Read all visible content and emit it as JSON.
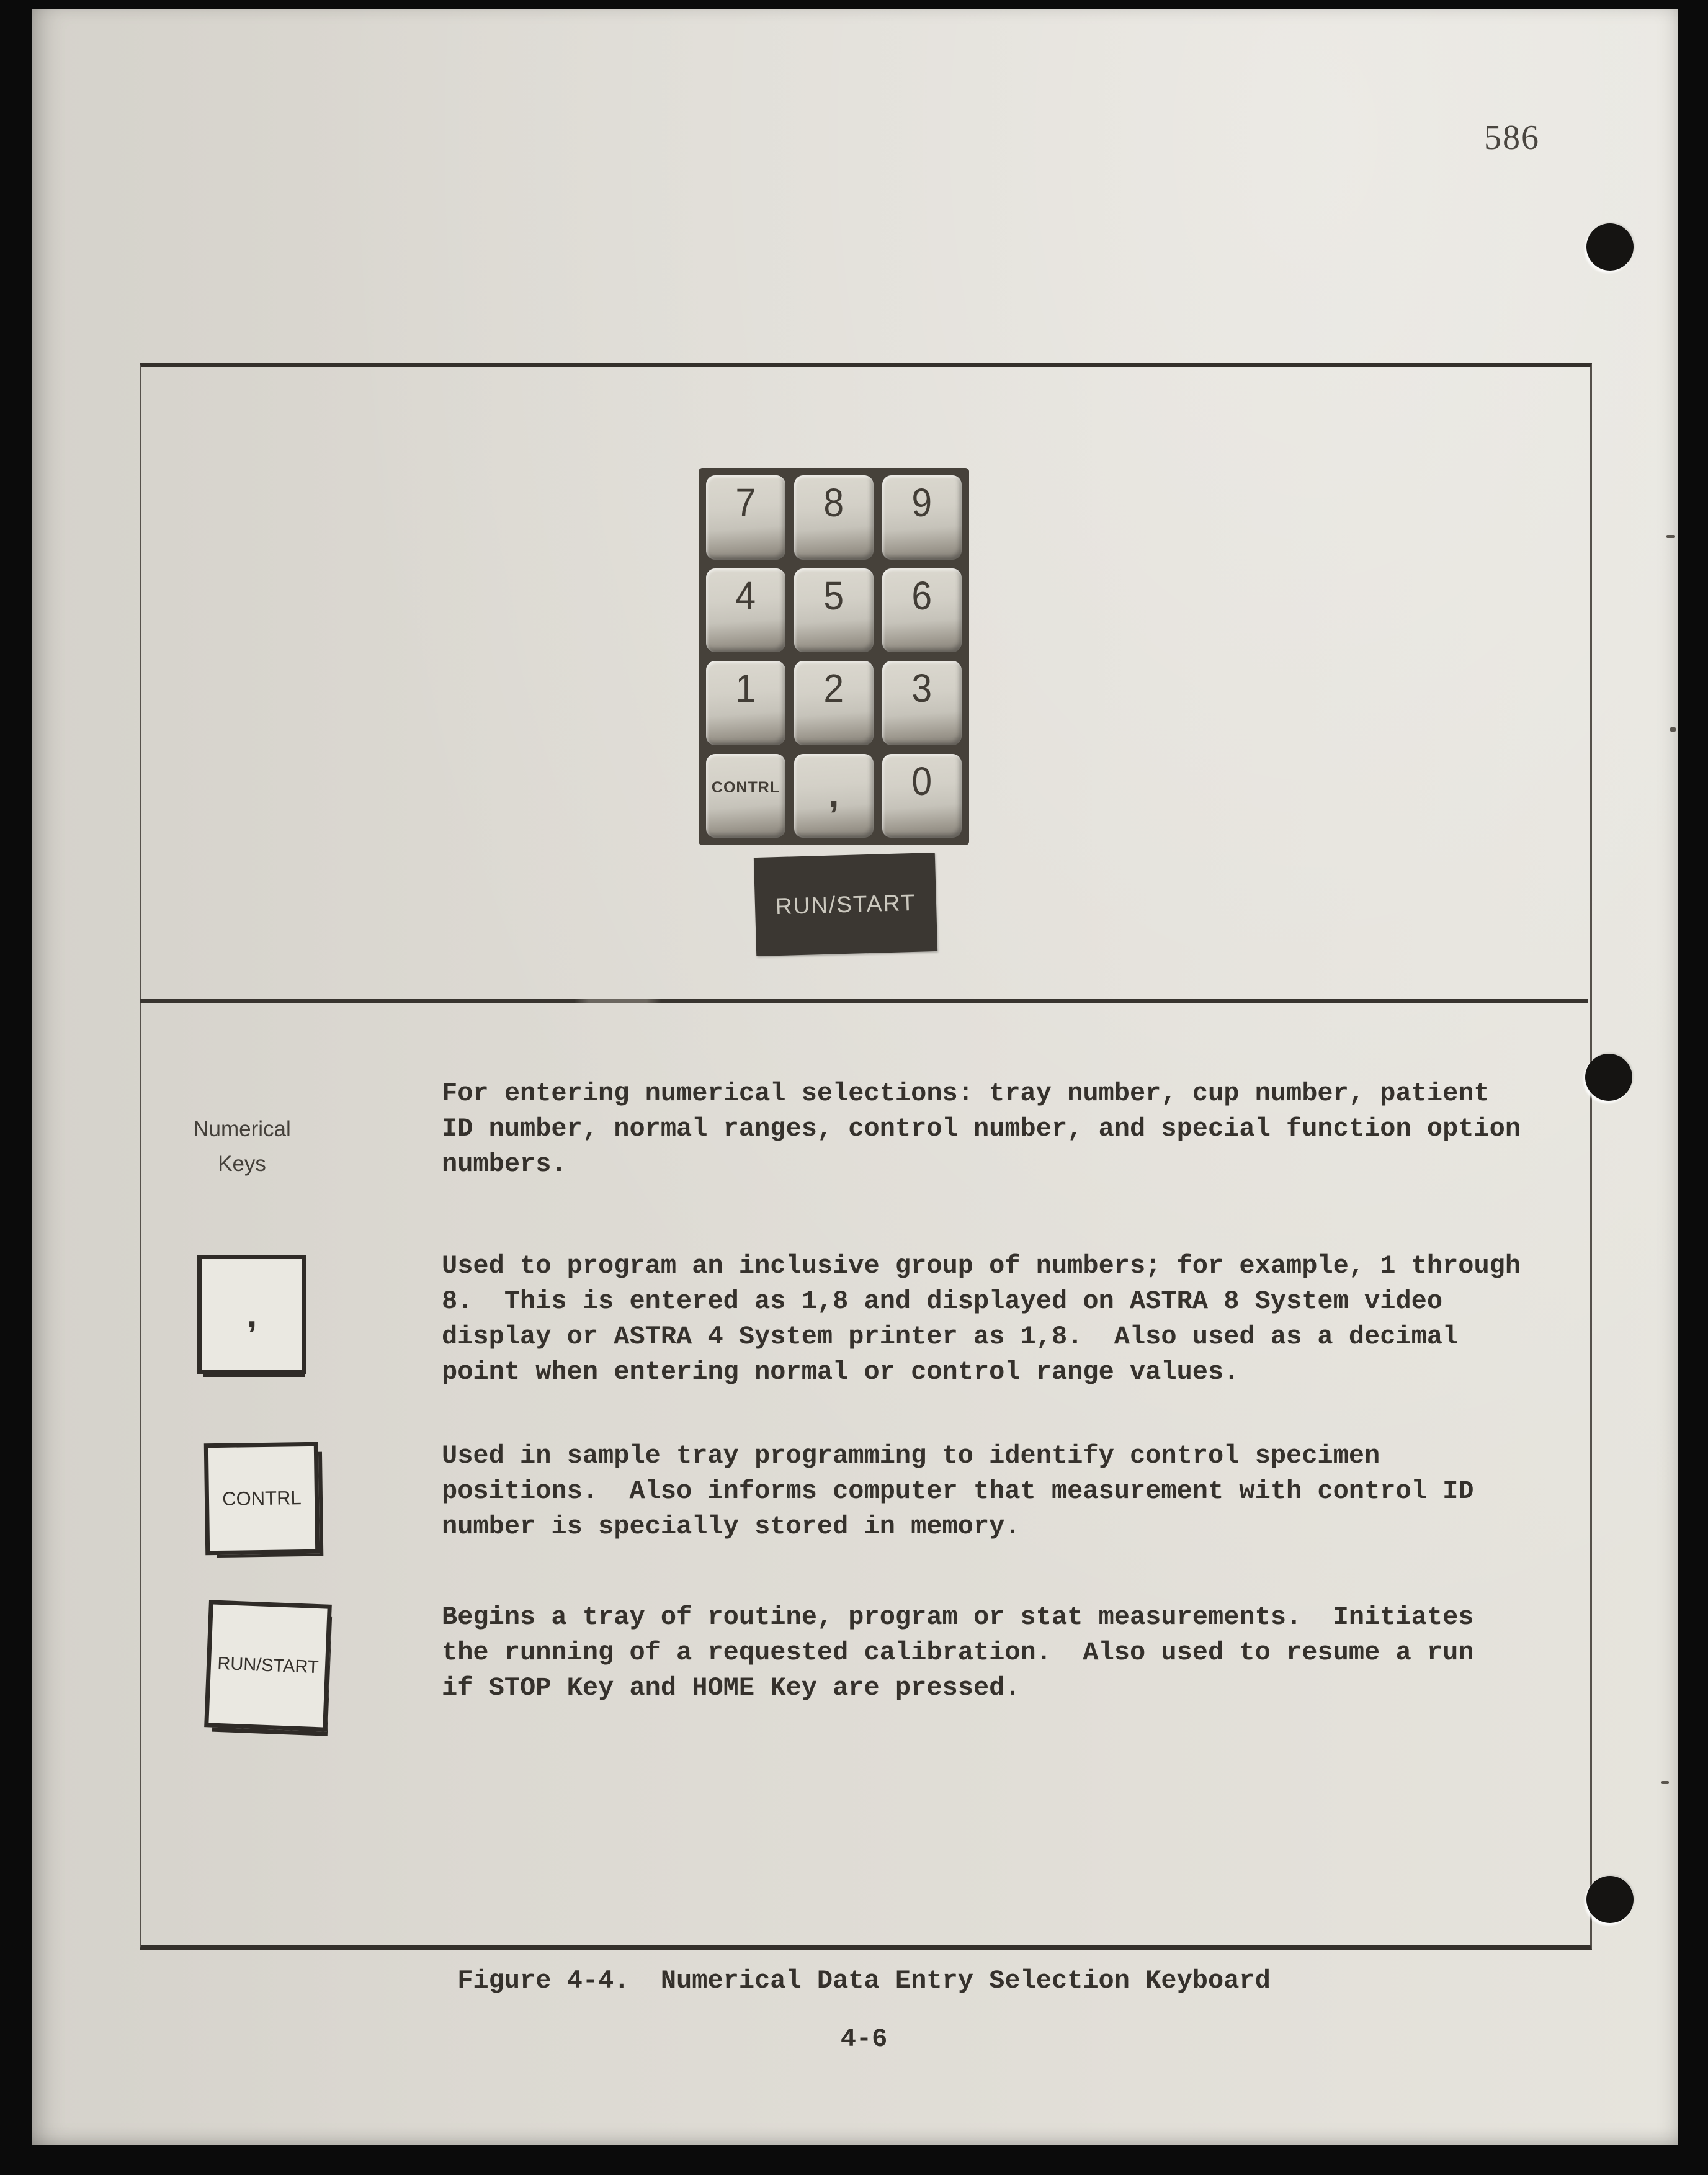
{
  "page": {
    "top_page_number": "586",
    "bottom_page_number": "4-6",
    "figure_caption": "Figure 4-4.  Numerical Data Entry Selection Keyboard"
  },
  "keypad_figure": {
    "keys": [
      [
        "7",
        "8",
        "9"
      ],
      [
        "4",
        "5",
        "6"
      ],
      [
        "1",
        "2",
        "3"
      ],
      [
        "CONTRL",
        ",",
        "0"
      ]
    ],
    "run_start_label": "RUN/START"
  },
  "entries": [
    {
      "label": "Numerical\nKeys",
      "text": "For entering numerical selections: tray number, cup number, patient\nID number, normal ranges, control number, and special function option\nnumbers."
    },
    {
      "key_label": ",",
      "text": "Used to program an inclusive group of numbers; for example, 1 through\n8.  This is entered as 1,8 and displayed on ASTRA 8 System video\ndisplay or ASTRA 4 System printer as 1,8.  Also used as a decimal\npoint when entering normal or control range values."
    },
    {
      "key_label": "CONTRL",
      "text": "Used in sample tray programming to identify control specimen\npositions.  Also informs computer that measurement with control ID\nnumber is specially stored in memory."
    },
    {
      "key_label": "RUN/START",
      "text": "Begins a tray of routine, program or stat measurements.  Initiates\nthe running of a requested calibration.  Also used to resume a run\nif STOP Key and HOME Key are pressed."
    }
  ],
  "colors": {
    "paper": "#e2dfd8",
    "ink": "#35312c",
    "photo_dark": "#3b3732",
    "scan_border": "#0b0b0b"
  }
}
